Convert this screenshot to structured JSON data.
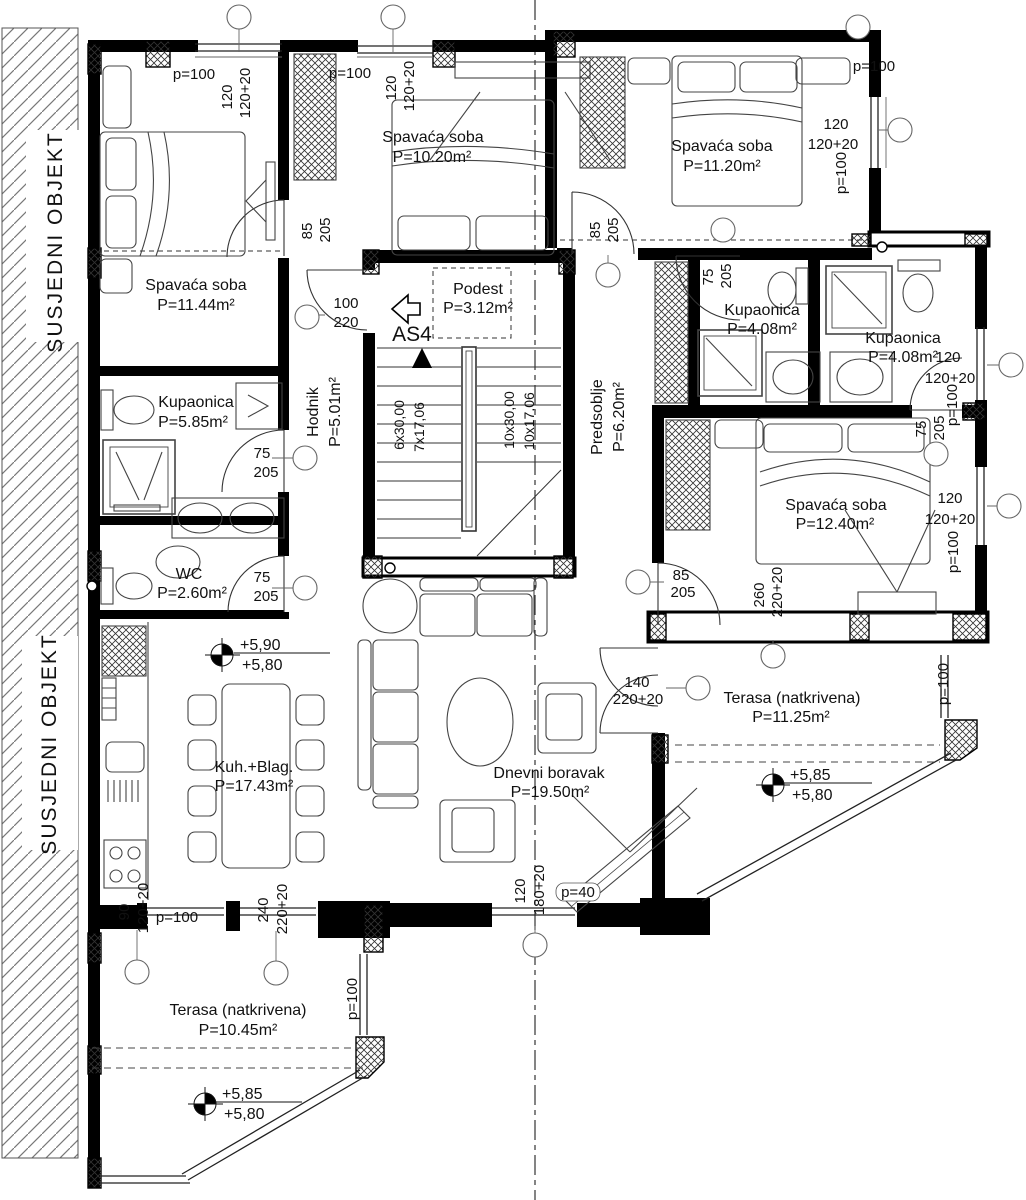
{
  "plan": {
    "neighbor_label": "SUSJEDNI OBJEKT",
    "stair_marker": "AS4"
  },
  "rooms": [
    {
      "name": "Spavaća soba",
      "area": "P=11.44m²"
    },
    {
      "name": "Spavaća soba",
      "area": "P=10.20m²"
    },
    {
      "name": "Spavaća soba",
      "area": "P=11.20m²"
    },
    {
      "name": "Podest",
      "area": "P=3.12m²"
    },
    {
      "name": "Hodnik",
      "area": "P=5.01m²"
    },
    {
      "name": "Predsoblje",
      "area": "P=6.20m²"
    },
    {
      "name": "Kupaonica",
      "area": "P=5.85m²"
    },
    {
      "name": "Kupaonica",
      "area": "P=4.08m²"
    },
    {
      "name": "Kupaonica",
      "area": "P=4.08m²"
    },
    {
      "name": "WC",
      "area": "P=2.60m²"
    },
    {
      "name": "Spavaća soba",
      "area": "P=12.40m²"
    },
    {
      "name": "Kuh.+Blag.",
      "area": "P=17.43m²"
    },
    {
      "name": "Dnevni boravak",
      "area": "P=19.50m²"
    },
    {
      "name": "Terasa (natkrivena)",
      "area": "P=11.25m²"
    },
    {
      "name": "Terasa (natkrivena)",
      "area": "P=10.45m²"
    }
  ],
  "stairs": {
    "flight1_run": "6x30,00",
    "flight1_rise": "7x17,06",
    "flight2_run": "10x30,00",
    "flight2_rise": "10x17,06"
  },
  "levels": [
    {
      "upper": "+5,90",
      "lower": "+5,80"
    },
    {
      "upper": "+5,85",
      "lower": "+5,80"
    },
    {
      "upper": "+5,85",
      "lower": "+5,80"
    }
  ],
  "dims": [
    "p=100",
    "120",
    "120+20",
    "p=100",
    "120",
    "120+20",
    "p=100",
    "120",
    "120+20",
    "p=100",
    "85",
    "205",
    "85",
    "205",
    "100",
    "220",
    "75",
    "205",
    "120",
    "120+20",
    "p=100",
    "75",
    "205",
    "75",
    "205",
    "75",
    "205",
    "120",
    "120+20",
    "p=100",
    "85",
    "205",
    "260",
    "220+20",
    "140",
    "220+20",
    "p=100",
    "120",
    "180+20",
    "p=40",
    "90",
    "120+20",
    "p=100",
    "240",
    "220+20",
    "p=100"
  ]
}
